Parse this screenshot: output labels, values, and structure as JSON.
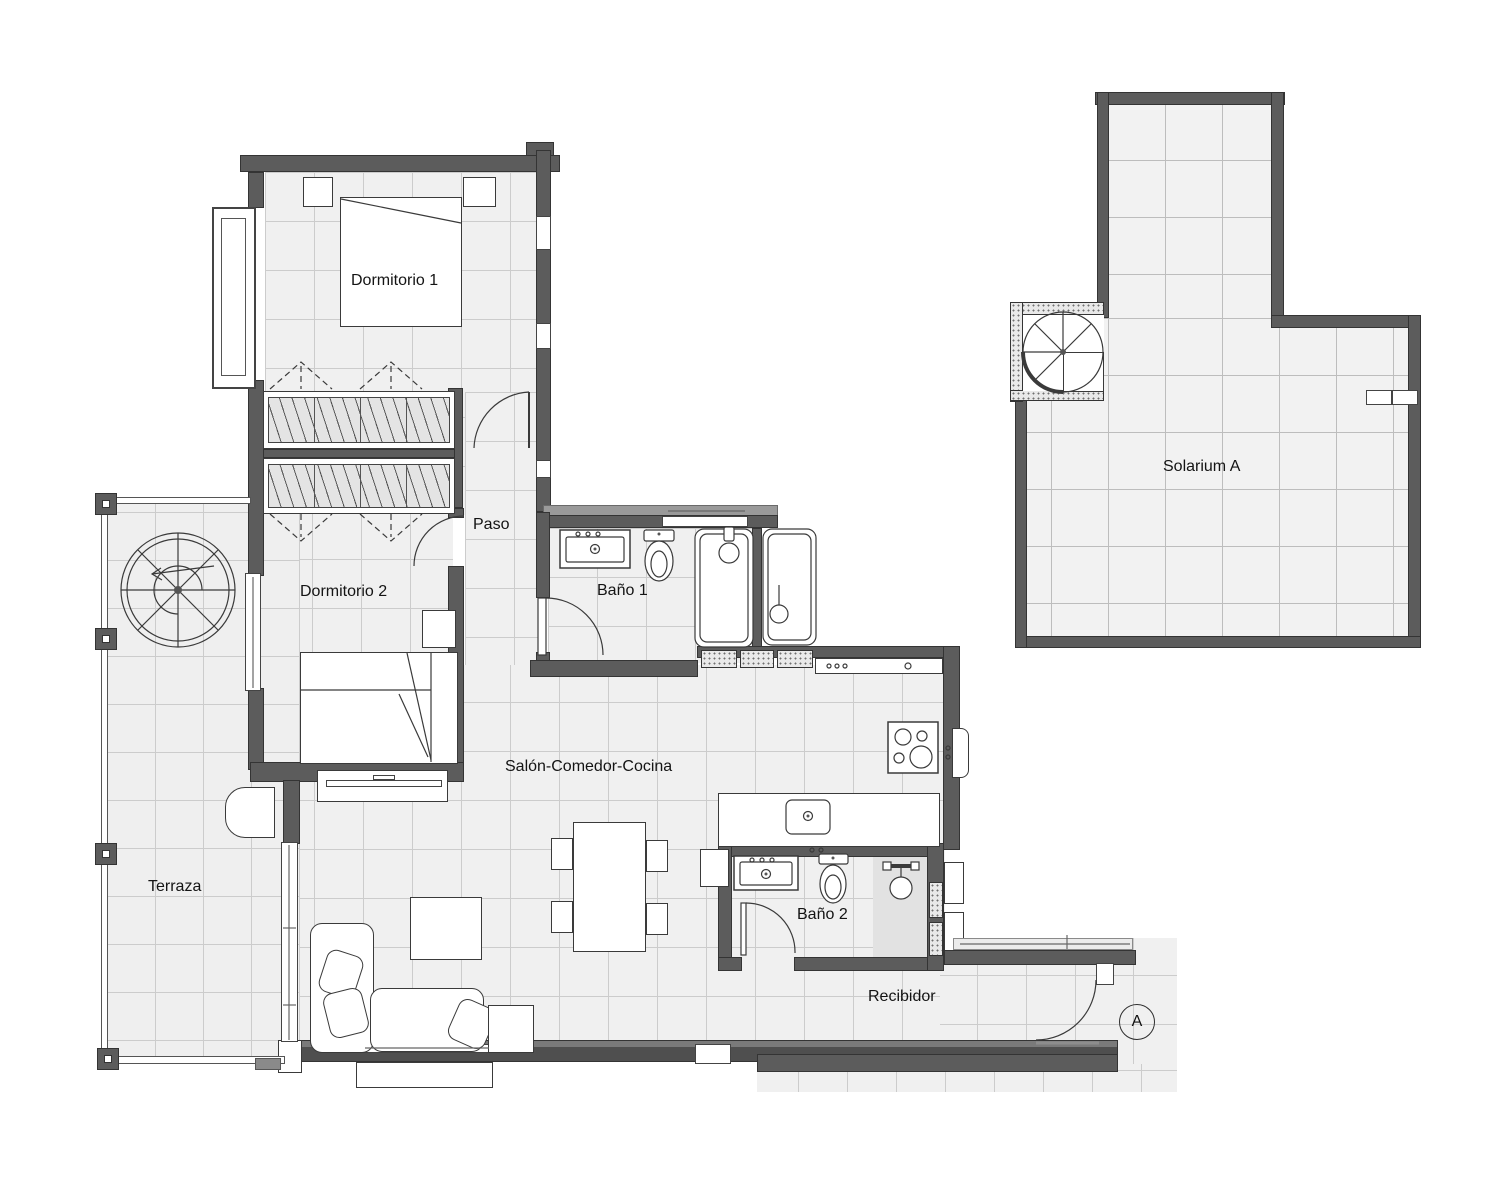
{
  "plan": {
    "title": "apartment-floor-plan",
    "rooms": {
      "dormitorio1": {
        "label": "Dormitorio 1"
      },
      "dormitorio2": {
        "label": "Dormitorio 2"
      },
      "paso": {
        "label": "Paso"
      },
      "bano1": {
        "label": "Baño 1"
      },
      "bano2": {
        "label": "Baño 2"
      },
      "salon": {
        "label": "Salón-Comedor-Cocina"
      },
      "terraza": {
        "label": "Terraza"
      },
      "recibidor": {
        "label": "Recibidor"
      },
      "solarium": {
        "label": "Solarium A"
      }
    },
    "section_marker": {
      "label": "A"
    },
    "icons": [
      "double-bed",
      "single-bed",
      "wardrobe",
      "spiral-staircase",
      "bathtub",
      "toilet",
      "washbasin",
      "shower",
      "cooktop",
      "kitchen-island-sink",
      "dining-table",
      "chair",
      "sofa",
      "coffee-table",
      "tv-unit",
      "door-swing",
      "window",
      "ac-unit"
    ],
    "colors": {
      "wall": "#5c5c5c",
      "floor": "#f0f0f0",
      "grid_line": "#cccccc",
      "solarium_floor": "#f2f2f2",
      "shower_shade": "#e2e2e2",
      "outline": "#3a3a3a"
    }
  }
}
